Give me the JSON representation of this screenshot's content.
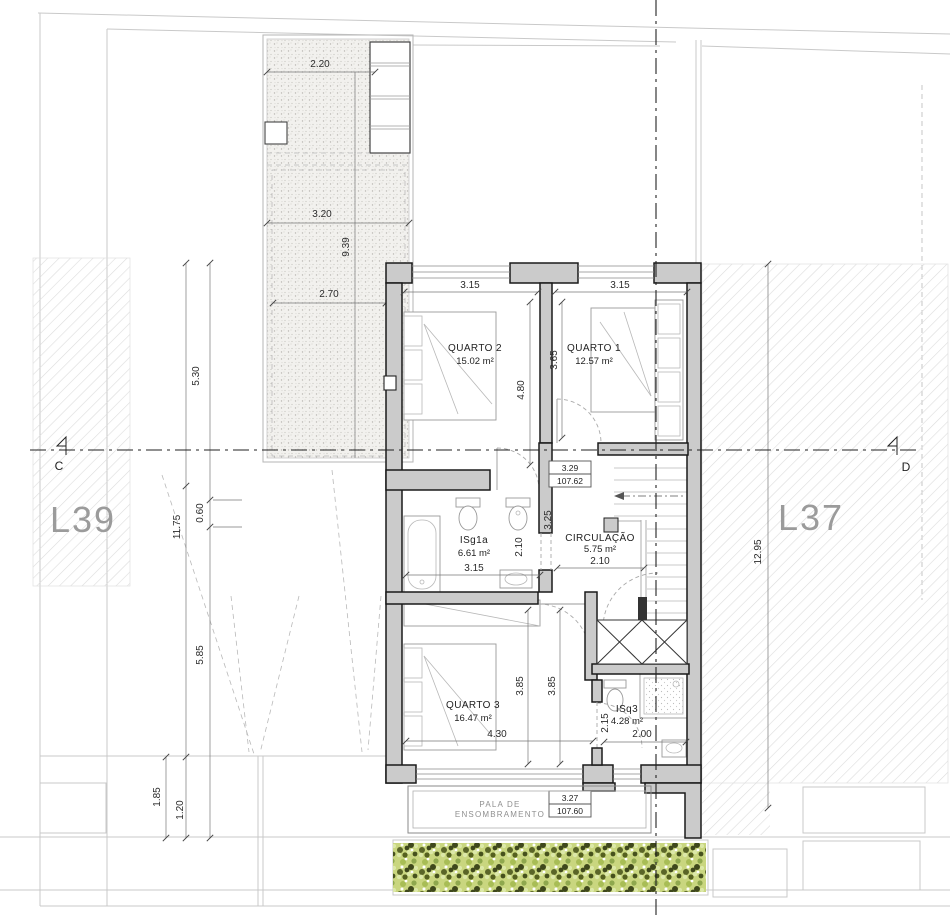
{
  "lots": {
    "left": "L39",
    "right": "L37"
  },
  "section_markers": {
    "left": "C",
    "right": "D"
  },
  "rooms": {
    "quarto2": {
      "name": "QUARTO 2",
      "area": "15.02 m²"
    },
    "quarto1": {
      "name": "QUARTO 1",
      "area": "12.57 m²"
    },
    "isg1a": {
      "name": "ISg1a",
      "area": "6.61 m²"
    },
    "circulacao": {
      "name": "CIRCULAÇÃO",
      "area": "5.75 m²"
    },
    "quarto3": {
      "name": "QUARTO 3",
      "area": "16.47 m²"
    },
    "isq3": {
      "name": "ISq3",
      "area": "4.28 m²"
    }
  },
  "levels": {
    "mid": {
      "height": "3.29",
      "elevation": "107.62"
    },
    "lower": {
      "height": "3.27",
      "elevation": "107.60"
    }
  },
  "pala": {
    "line1": "PALA DE",
    "line2": "ENSOMBRAMENTO"
  },
  "dims": {
    "terrace_top": "2.20",
    "terrace_mid": "3.20",
    "terrace_height": "9.39",
    "terrace_bottom": "2.70",
    "left_530": "5.30",
    "left_1175": "11.75",
    "left_060": "0.60",
    "left_585": "5.85",
    "left_185": "1.85",
    "left_120": "1.20",
    "right_1295": "12.95",
    "q2_width": "3.15",
    "q1_width": "3.15",
    "q2_depth": "4.80",
    "q1_depth": "3.65",
    "isg_width": "3.15",
    "isg_depth": "2.10",
    "hall_325": "3.25",
    "circ_width": "2.10",
    "q3_depth_a": "3.85",
    "q3_depth_b": "3.85",
    "q3_width": "4.30",
    "isq3_depth": "2.15",
    "isq3_width": "2.00"
  },
  "colors": {
    "wall_fill": "#cbcbcb",
    "line_dark": "#1a1a1a",
    "hatch_line": "#d9d9d9",
    "hedge_light": "#c5d478",
    "hedge_dark": "#46501f",
    "lot_label": "#9b9b9b"
  }
}
